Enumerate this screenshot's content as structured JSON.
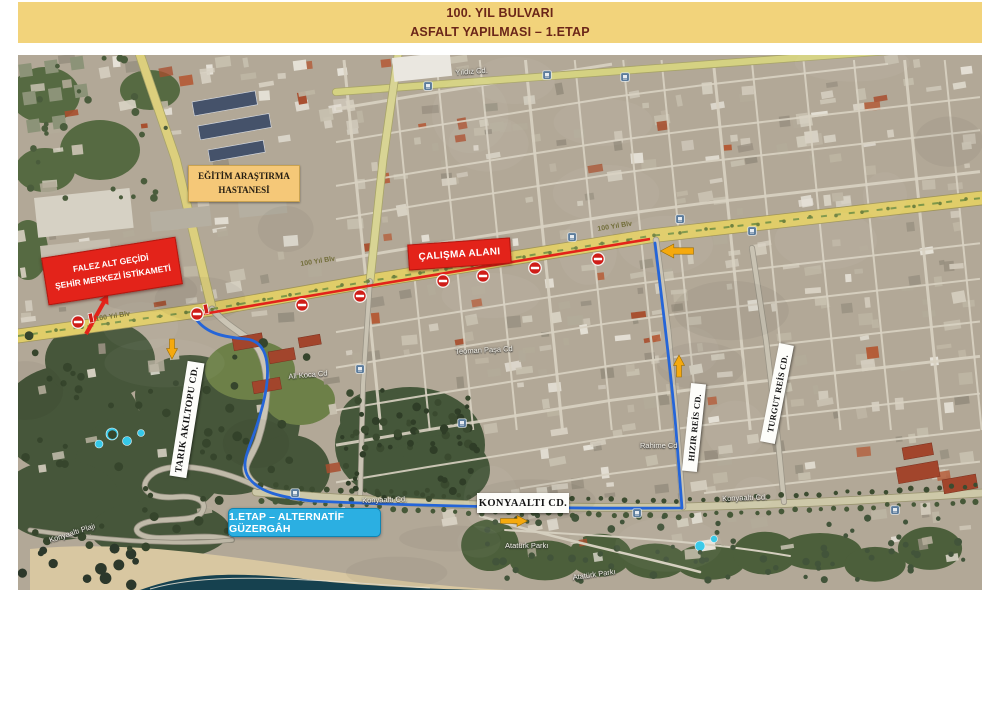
{
  "title": {
    "line1": "100. YIL BULVARI",
    "line2": "ASFALT YAPILMASI – 1.ETAP"
  },
  "labels": {
    "hospital_line1": "EĞİTİM ARAŞTIRMA",
    "hospital_line2": "HASTANESİ",
    "falez_line1": "FALEZ ALT GEÇİDİ",
    "falez_line2": "ŞEHİR MERKEZİ İSTİKAMETİ",
    "calisma": "ÇALIŞMA ALANI",
    "tarik": "TARIK AKILTOPU CD.",
    "hizir": "HIZIR REİS CD.",
    "turgut": "TURGUT REİS CD.",
    "konyaalti": "KONYAALTI CD.",
    "etap": "1.ETAP – ALTERNATİF GÜZERGÂH"
  },
  "map_texts": [
    {
      "t": "Yıldız Cd.",
      "x": 455,
      "y": 68,
      "r": -4,
      "c": "white"
    },
    {
      "t": "100 Yıl Blv",
      "x": 95,
      "y": 316,
      "r": -9,
      "c": "road"
    },
    {
      "t": "100 Yıl Blv",
      "x": 300,
      "y": 261,
      "r": -9,
      "c": "road"
    },
    {
      "t": "100 Yıl Blv",
      "x": 597,
      "y": 226,
      "r": -9,
      "c": "road"
    },
    {
      "t": "Teoman Paşa Cd",
      "x": 455,
      "y": 347,
      "r": -3,
      "c": "white"
    },
    {
      "t": "Ali Koca Cd",
      "x": 288,
      "y": 372,
      "r": -5,
      "c": "white"
    },
    {
      "t": "Rahime Cd",
      "x": 640,
      "y": 441,
      "r": 0,
      "c": "white"
    },
    {
      "t": "Konyaaltı Cd.",
      "x": 362,
      "y": 496,
      "r": -2,
      "c": "white"
    },
    {
      "t": "Konyaaltı Cd.",
      "x": 722,
      "y": 494,
      "r": -2,
      "c": "white"
    },
    {
      "t": "Konyaaltı Plajı",
      "x": 48,
      "y": 536,
      "r": -18,
      "c": "white"
    },
    {
      "t": "Atatürk Parkı",
      "x": 505,
      "y": 541,
      "r": 0,
      "c": "white"
    },
    {
      "t": "Atatürk Parkı",
      "x": 572,
      "y": 573,
      "r": -8,
      "c": "white"
    }
  ],
  "overlays": {
    "closed_route": "M197,315 L368,286 L650,239",
    "alt_route": "M196,319 C207,334 224,337 246,339 C274,342 270,382 260,415 C252,446 238,462 249,478 C259,492 280,497 312,501 C420,506 560,509 682,508 L676,430 C672,382 662,300 655,243",
    "falez_arrow": {
      "x1": 86,
      "y1": 334,
      "x2": 104,
      "y2": 302,
      "head": "108,294 108.5,305 99,300"
    },
    "no_entry_signs": [
      [
        78,
        322
      ],
      [
        197,
        314
      ],
      [
        302,
        305
      ],
      [
        360,
        296
      ],
      [
        443,
        281
      ],
      [
        483,
        276
      ],
      [
        535,
        268
      ],
      [
        598,
        259
      ]
    ],
    "barrier_bars": [
      [
        91,
        318
      ],
      [
        206,
        309
      ]
    ],
    "direction_arrows": [
      {
        "x": 172,
        "y": 349,
        "dir": "down",
        "len": 20,
        "w": 11
      },
      {
        "x": 514,
        "y": 521,
        "dir": "right",
        "len": 27,
        "w": 11
      },
      {
        "x": 679,
        "y": 366,
        "dir": "up",
        "len": 22,
        "w": 11
      },
      {
        "x": 677,
        "y": 251,
        "dir": "left",
        "len": 33,
        "w": 14
      }
    ],
    "road_shields": [
      [
        428,
        86
      ],
      [
        547,
        75
      ],
      [
        625,
        77
      ],
      [
        680,
        219
      ],
      [
        752,
        231
      ],
      [
        572,
        237
      ],
      [
        360,
        369
      ],
      [
        462,
        423
      ],
      [
        295,
        493
      ],
      [
        637,
        513
      ],
      [
        895,
        510
      ]
    ]
  },
  "colors": {
    "banner_bg": "#f2d37b",
    "banner_text": "#6b2619",
    "closure_red": "#e3231a",
    "route_blue": "#2565d8",
    "alt_label_bg": "#2bafe2",
    "arrow_yellow": "#f5a90e",
    "label_tan": "#f5c878"
  }
}
